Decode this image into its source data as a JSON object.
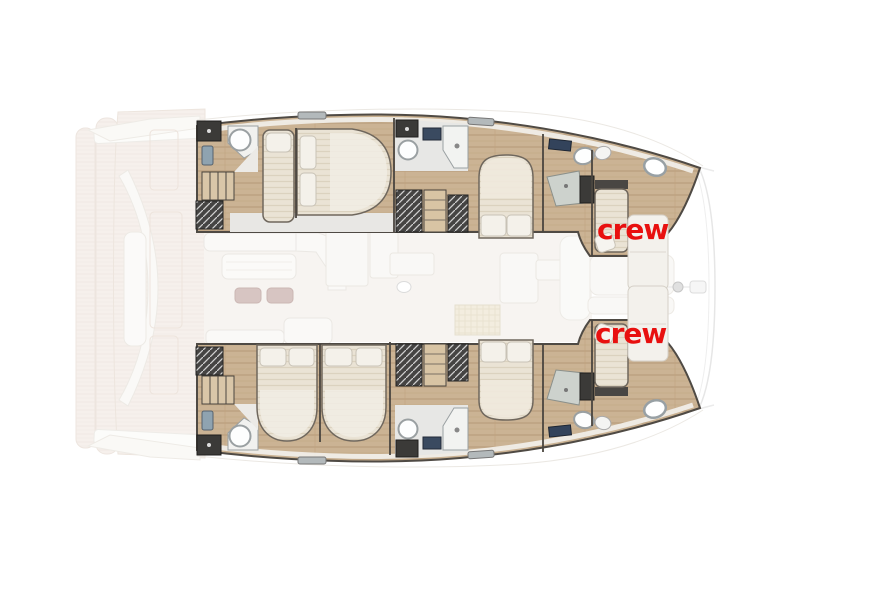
{
  "page": {
    "background": "#ffffff"
  },
  "plan": {
    "kind": "catamaran-deck-plan",
    "bow_direction": "right",
    "label_color": "#e8100f",
    "labels": [
      {
        "id": "crew-port",
        "text": "crew"
      },
      {
        "id": "crew-starboard",
        "text": "crew"
      }
    ],
    "colors": {
      "hull_wood": "#cbb394",
      "faded_deck_wood": "#eee3da",
      "bathroom_floor": "#e7e7e5",
      "white_furniture": "#f6f4f0",
      "dark_fixtures": "#3b3a38",
      "bed_fabric": "#eae3d5",
      "pouf_rose": "#b18c86",
      "navy_window": "#33435b",
      "outline": "#4f4a44"
    }
  }
}
